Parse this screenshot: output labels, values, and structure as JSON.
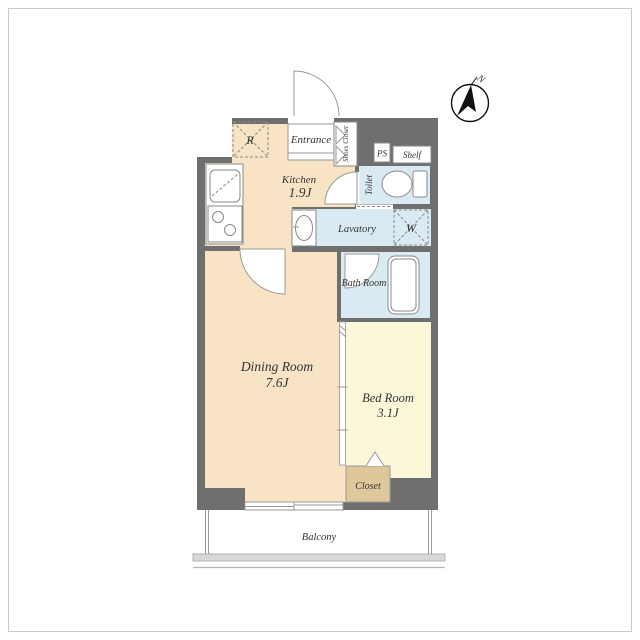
{
  "title": "Apartment Floor Plan",
  "compass": {
    "label": "N"
  },
  "rooms": {
    "entrance": "Entrance",
    "shoes_closet": "Shoes Closet",
    "ps": "PS",
    "shelf": "Shelf",
    "toilet": "Toilet",
    "lavatory": "Lavatory",
    "bath": "Bath Room",
    "kitchen_name": "Kitchen",
    "kitchen_size": "1.9J",
    "dining_name": "Dining Room",
    "dining_size": "7.6J",
    "bedroom_name": "Bed Room",
    "bedroom_size": "3.1J",
    "closet": "Closet",
    "balcony": "Balcony",
    "washer_symbol": "W",
    "fridge_symbol": "R"
  },
  "colors": {
    "wall": "#6f6f6f",
    "living_floor": "#f8e3c4",
    "bedroom_floor": "#fbf8da",
    "wet_floor": "#d9eaf2",
    "closet_floor": "#dfc79c",
    "frame": "#c9c9c9",
    "text": "#333333"
  }
}
